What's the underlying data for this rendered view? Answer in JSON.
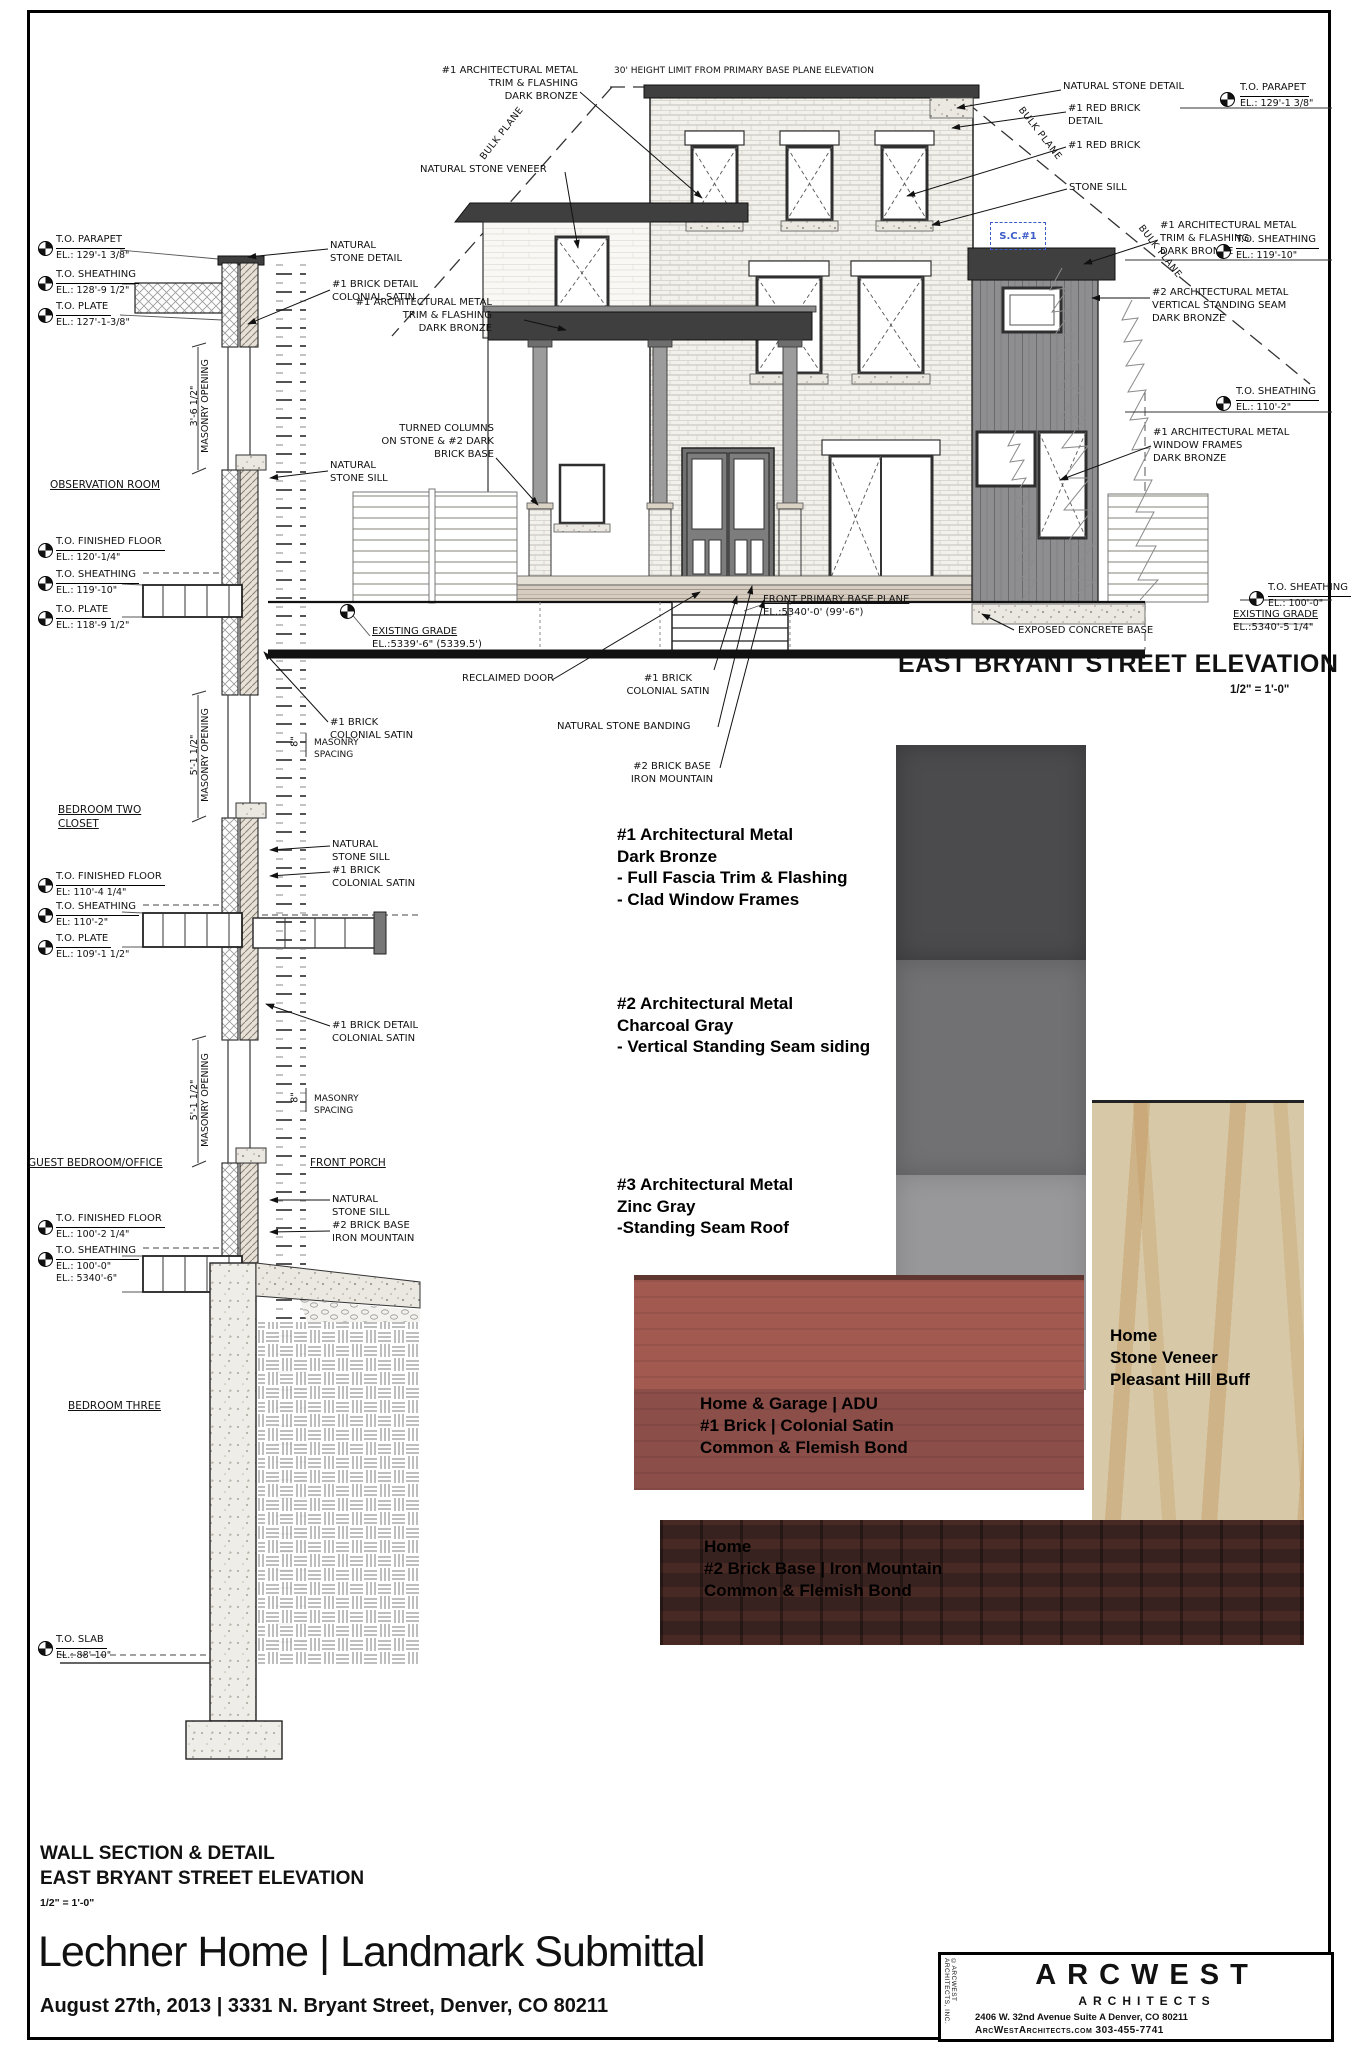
{
  "wall_section": {
    "markers": [
      {
        "name": "T.O. PARAPET",
        "el": "EL.: 129'-1 3/8\""
      },
      {
        "name": "T.O. SHEATHING",
        "el": "EL.: 128'-9 1/2\""
      },
      {
        "name": "T.O. PLATE",
        "el": "EL.: 127'-1-3/8\""
      },
      {
        "name": "T.O. FINISHED FLOOR",
        "el": "EL.: 120'-1/4\""
      },
      {
        "name": "T.O. SHEATHING",
        "el": "EL.: 119'-10\""
      },
      {
        "name": "T.O. PLATE",
        "el": "EL.: 118'-9 1/2\""
      },
      {
        "name": "T.O. FINISHED FLOOR",
        "el": "EL: 110'-4 1/4\""
      },
      {
        "name": "T.O. SHEATHING",
        "el": "EL: 110'-2\""
      },
      {
        "name": "T.O. PLATE",
        "el": "EL.: 109'-1 1/2\""
      },
      {
        "name": "T.O. FINISHED FLOOR",
        "el": "EL.: 100'-2 1/4\""
      },
      {
        "name": "T.O. SHEATHING",
        "el": "EL.: 100'-0\"",
        "el2": "EL.: 5340'-6\""
      },
      {
        "name": "T.O. SLAB",
        "el": "EL.: 88'-10\""
      }
    ],
    "rooms": {
      "observation": "OBSERVATION ROOM",
      "bedroom_two": "BEDROOM TWO\nCLOSET",
      "guest": "GUEST BEDROOM/OFFICE",
      "front_porch": "FRONT PORCH",
      "bedroom_three": "BEDROOM THREE"
    },
    "dims": {
      "open1": "3'-6 1/2\"",
      "open2": "5'-1 1/2\"",
      "open3": "5'-1 1/2\"",
      "masonry_opening": "MASONRY OPENING",
      "masonry_spacing": "MASONRY\nSPACING",
      "spacing_dim": "8\""
    },
    "callouts": [
      "NATURAL\nSTONE DETAIL",
      "#1 BRICK DETAIL\nCOLONIAL SATIN",
      "NATURAL\nSTONE SILL",
      "#1 BRICK\nCOLONIAL SATIN",
      "NATURAL\nSTONE SILL\n#1 BRICK\nCOLONIAL SATIN",
      "#1 BRICK DETAIL\nCOLONIAL SATIN",
      "NATURAL\nSTONE SILL\n#2 BRICK BASE\nIRON MOUNTAIN"
    ]
  },
  "elevation_view": {
    "title": "EAST BRYANT STREET ELEVATION",
    "scale": "1/2\" = 1'-0\"",
    "height_limit": "30' HEIGHT LIMIT FROM PRIMARY BASE PLANE ELEVATION",
    "bulk_plane": "BULK PLANE",
    "sc_tag": "S.C.#1",
    "labels": {
      "metal_trim_top": "#1 ARCHITECTURAL METAL\nTRIM & FLASHING\nDARK BRONZE",
      "stone_veneer": "NATURAL STONE VENEER",
      "metal_trim_porch": "#1 ARCHITECTURAL METAL\nTRIM & FLASHING\nDARK BRONZE",
      "turned_columns": "TURNED COLUMNS\nON STONE & #2 DARK\nBRICK BASE",
      "reclaimed_door": "RECLAIMED DOOR",
      "brick1_center": "#1 BRICK\nCOLONIAL SATIN",
      "stone_banding": "NATURAL STONE BANDING",
      "brick2_base": "#2 BRICK BASE\nIRON MOUNTAIN",
      "front_base_plane": "FRONT PRIMARY BASE PLANE",
      "front_base_plane_el": "EL.:5340'-0' (99'-6\")",
      "existing_grade_left": "EXISTING GRADE",
      "existing_grade_left_el": "EL.:5339'-6\" (5339.5')",
      "existing_grade_right": "EXISTING GRADE",
      "existing_grade_right_el": "EL.:5340'-5 1/4\"",
      "exposed_concrete": "EXPOSED CONCRETE BASE",
      "stone_detail_right": "NATURAL STONE DETAIL",
      "red_brick_detail": "#1 RED BRICK\nDETAIL",
      "red_brick": "#1 RED BRICK",
      "stone_sill_right": "STONE SILL",
      "metal_trim_right": "#1 ARCHITECTURAL METAL\nTRIM & FLASHING\nDARK BRONZE",
      "metal_seam_right": "#2 ARCHITECTURAL METAL\nVERTICAL STANDING SEAM\nDARK BRONZE",
      "window_frames_right": "#1 ARCHITECTURAL METAL\nWINDOW FRAMES\nDARK BRONZE"
    },
    "markers": [
      {
        "name": "T.O. PARAPET",
        "el": "EL.: 129'-1 3/8\""
      },
      {
        "name": "T.O. SHEATHING",
        "el": "EL.: 119'-10\""
      },
      {
        "name": "T.O. SHEATHING",
        "el": "EL.: 110'-2\""
      },
      {
        "name": "T.O. SHEATHING",
        "el": "EL.: 100'-0\""
      }
    ]
  },
  "materials": {
    "metal_labels": [
      "#1 Architectural Metal\nDark Bronze\n- Full Fascia Trim & Flashing\n- Clad Window Frames",
      "#2 Architectural Metal\nCharcoal Gray\n- Vertical Standing Seam siding",
      "#3 Architectural Metal\nZinc Gray\n-Standing Seam Roof"
    ],
    "brick1_label": "Home & Garage | ADU\n#1 Brick | Colonial Satin\nCommon & Flemish Bond",
    "stone_label": "Home\nStone Veneer\nPleasant Hill Buff",
    "brick2_label": "Home\n#2 Brick Base | Iron Mountain\nCommon & Flemish Bond",
    "colors": {
      "metal1": "#4b4b4d",
      "metal2": "#717173",
      "metal3": "#98989a",
      "brick1": "#a2594f",
      "stone": "#d7c9a7",
      "brick2": "#372220"
    }
  },
  "titleblock": {
    "section_title1": "WALL SECTION & DETAIL",
    "section_title2": "EAST BRYANT STREET ELEVATION",
    "section_scale": "1/2\" = 1'-0\"",
    "project_title": "Lechner Home | Landmark Submittal",
    "date_address": "August 27th, 2013 | 3331 N. Bryant Street, Denver, CO 80211",
    "firm_name": "ARCWEST",
    "firm_sub": "ARCHITECTS",
    "firm_address": "2406 W. 32nd Avenue     Suite A     Denver, CO  80211",
    "firm_contact": "ArcWestArchitects.com      303-455-7741",
    "firm_side": "©ARCWEST ARCHITECTS, INC."
  }
}
